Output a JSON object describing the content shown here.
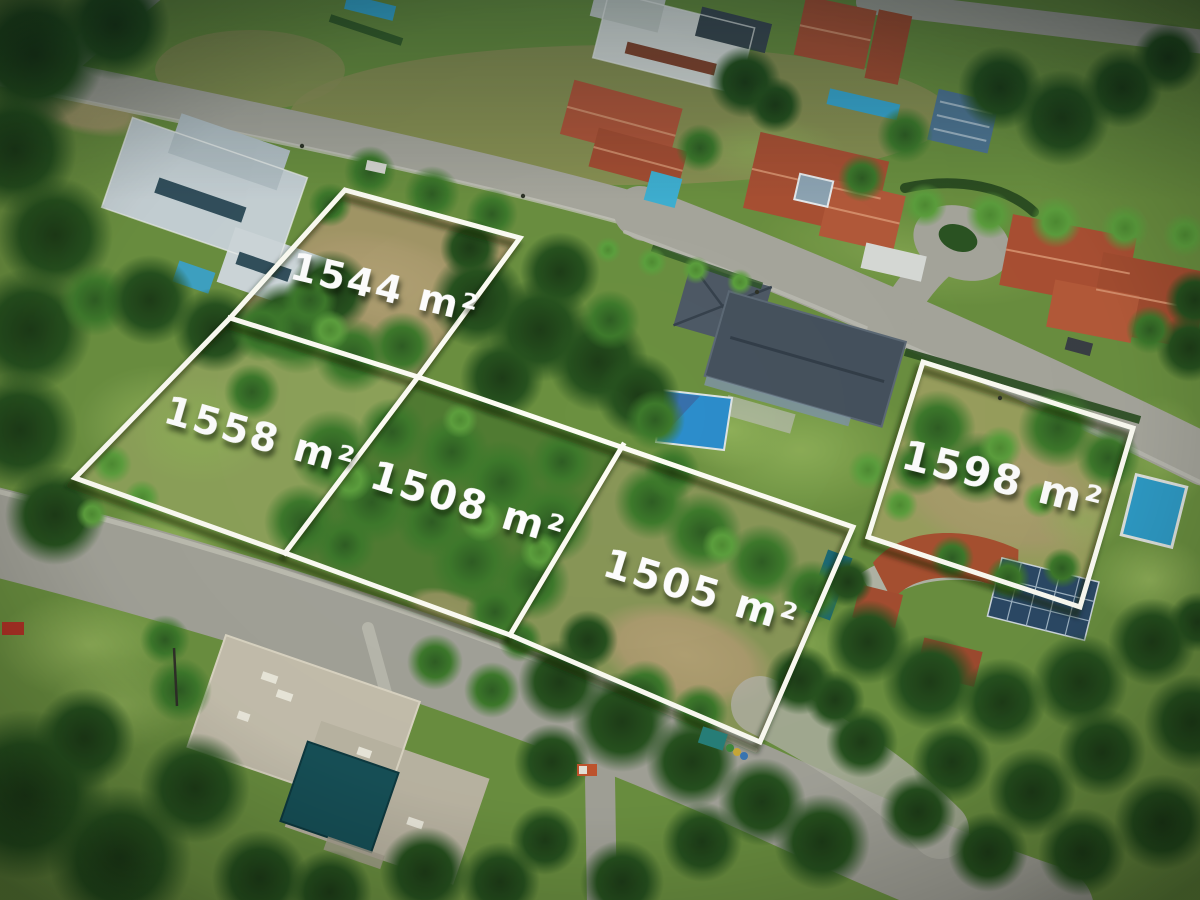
{
  "photo": {
    "kind": "aerial-drone-photo",
    "scene": "Aerial view of a tropical gated residential community with five vacant land lots outlined in white for sale"
  },
  "plots": [
    {
      "id": "lot-1544",
      "area_label": "1544 m²"
    },
    {
      "id": "lot-1558",
      "area_label": "1558 m²"
    },
    {
      "id": "lot-1508",
      "area_label": "1508 m²"
    },
    {
      "id": "lot-1505",
      "area_label": "1505 m²"
    },
    {
      "id": "lot-1598",
      "area_label": "1598 m²"
    }
  ],
  "style": {
    "boundary_color": "#fdfdf4",
    "label_color": "#ffffff"
  }
}
